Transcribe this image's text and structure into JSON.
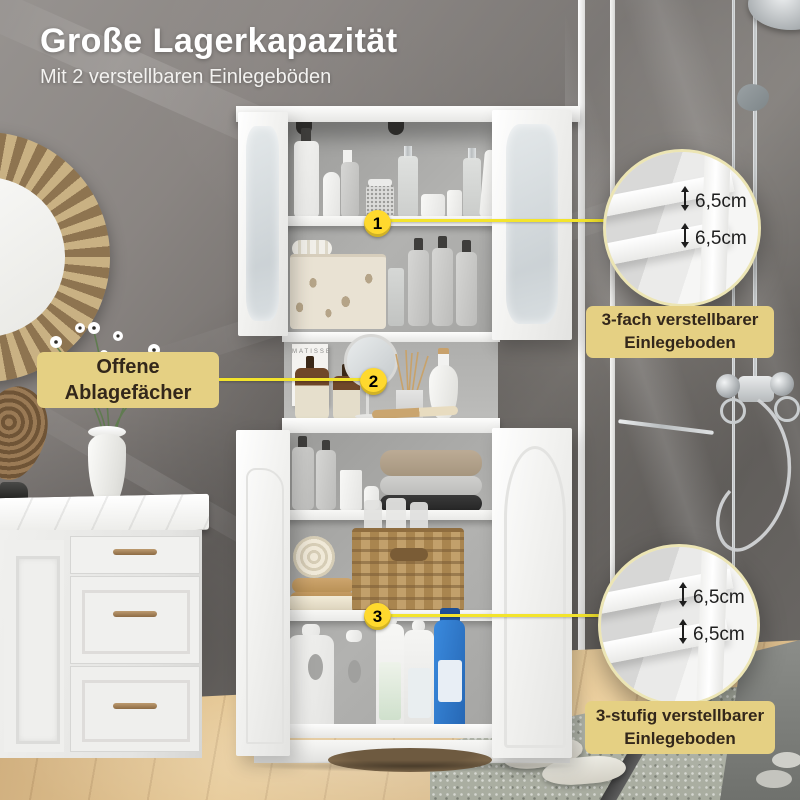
{
  "header": {
    "title": "Große Lagerkapazität",
    "subtitle": "Mit 2 verstellbaren Einlegeböden"
  },
  "callouts": {
    "open_shelf": {
      "line1": "Offene",
      "line2": "Ablagefächer"
    },
    "top_adjustable": {
      "line1": "3-fach verstellbarer",
      "line2": "Einlegeboden"
    },
    "bottom_adjustable": {
      "line1": "3-stufig verstellbarer",
      "line2": "Einlegeboden"
    }
  },
  "badges": {
    "b1": "1",
    "b2": "2",
    "b3": "3"
  },
  "measurements": {
    "top_circle": {
      "gap1": "6,5cm",
      "gap2": "6,5cm"
    },
    "bottom_circle": {
      "gap1": "6,5cm",
      "gap2": "6,5cm"
    }
  },
  "decor": {
    "book_title": "MATISSE"
  },
  "colors": {
    "line": "#f3e42c",
    "badge_bg": "#ffd92e",
    "badge_text": "#151310",
    "bubble_bg": "#e5d083",
    "bubble_text": "#33271b",
    "ring": "#ece5b4",
    "heading": "#ffffff"
  }
}
